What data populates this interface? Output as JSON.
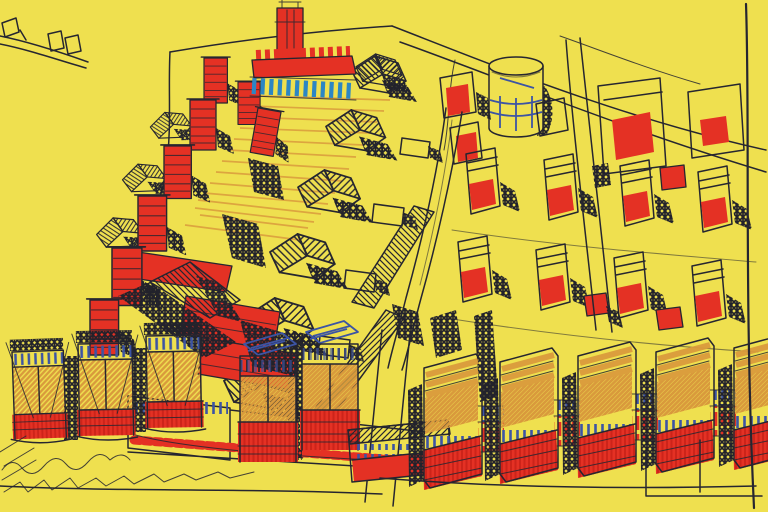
{
  "artwork": {
    "kind": "hand-drawn-urban-design-sketch",
    "view": "aerial-axonometric",
    "medium": "ink-and-marker-on-yellow-paper"
  },
  "palette": {
    "paper": "#efe04f",
    "ink": "#262630",
    "red": "#e43124",
    "red_deep": "#b5170f",
    "orange": "#d99a3c",
    "blue": "#3c54a4",
    "teal": "#2c86c4",
    "shadow": "#22222b"
  },
  "elements": [
    "distant-buildings-sketch",
    "street-lines",
    "plaza-terrace-lines",
    "row-houses-pitched-roofs",
    "red-tower-cascade",
    "landmark-campanile",
    "arcade-band",
    "gasometer-cylinder",
    "street-blocks-upper-right",
    "housing-grid",
    "terrace-roof-bands",
    "arcade-low-block",
    "slab-towers-left",
    "slab-towers-center",
    "slab-towers-right",
    "ground-scribbles",
    "paper-edge-line"
  ]
}
